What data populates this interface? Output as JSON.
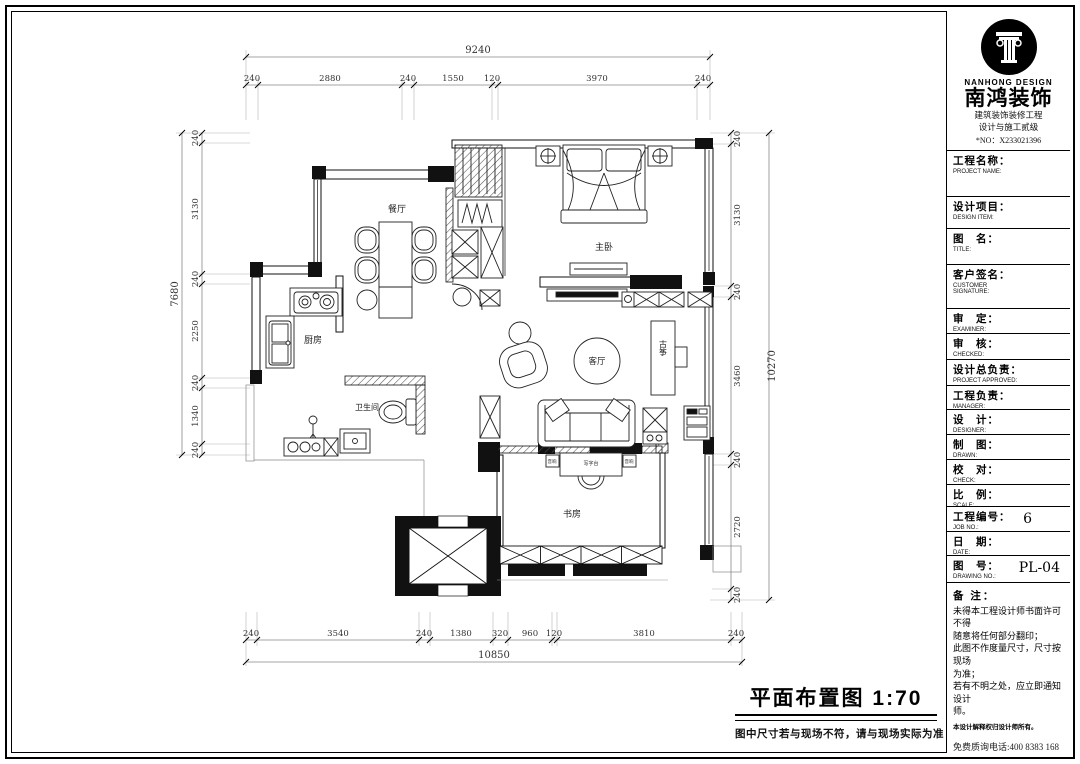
{
  "title_block": {
    "brand_en": "NANHONG DESIGN",
    "brand_zh": "南鸿装饰",
    "cert_line1": "建筑装饰装修工程",
    "cert_line2": "设计与施工贰级",
    "cert_no": "*NO：X233021396",
    "fields": [
      {
        "zh": "工程名称：",
        "en": "PROJECT NAME:",
        "value": ""
      },
      {
        "zh": "设计项目：",
        "en": "DESIGN ITEM:",
        "value": ""
      },
      {
        "zh": "图　名：",
        "en": "TITLE:",
        "value": ""
      },
      {
        "zh": "客户签名：",
        "en": "CUSTOMER SIGNATURE:",
        "value": ""
      },
      {
        "zh": "审　定：",
        "en": "EXAMINER:",
        "value": ""
      },
      {
        "zh": "审　核：",
        "en": "CHECKED:",
        "value": ""
      },
      {
        "zh": "设计总负责：",
        "en": "PROJECT APPROVED:",
        "value": ""
      },
      {
        "zh": "工程负责：",
        "en": "MANAGER:",
        "value": ""
      },
      {
        "zh": "设　计：",
        "en": "DESIGNER:",
        "value": ""
      },
      {
        "zh": "制　图：",
        "en": "DRAWN:",
        "value": ""
      },
      {
        "zh": "校　对：",
        "en": "CHECK:",
        "value": ""
      },
      {
        "zh": "比　例：",
        "en": "SCALE:",
        "value": ""
      },
      {
        "zh": "工程编号：",
        "en": "JOB NO.:",
        "value": "6"
      },
      {
        "zh": "日　期：",
        "en": "DATE:",
        "value": ""
      },
      {
        "zh": "图　号：",
        "en": "DRAWING NO.:",
        "value": "PL-04"
      }
    ],
    "notes_title": "备 注：",
    "notes": [
      "未得本工程设计师书面许可不得",
      "随意将任何部分翻印；",
      "此图不作度量尺寸，尺寸按现场",
      "为准；",
      "若有不明之处，应立即通知设计",
      "师。"
    ],
    "notes_small": "本设计解释权归设计师所有。",
    "phone": "免费质询电话:400 8383 168"
  },
  "drawing": {
    "title": "平面布置图  1:70",
    "subtitle": "图中尺寸若与现场不符，请与现场实际为准",
    "rooms": {
      "dining": "餐厅",
      "master": "主卧",
      "kitchen": "厨房",
      "bath": "卫生间",
      "living": "客厅",
      "guzheng": "古筝",
      "study": "书房"
    },
    "desk_labels": {
      "left": "音响",
      "center": "写字台",
      "right": "音响"
    }
  },
  "dims": {
    "top": {
      "total": "9240",
      "segments": [
        "240",
        "2880",
        "240",
        "1550",
        "120",
        "3970",
        "240"
      ]
    },
    "bottom": {
      "total": "10850",
      "segments": [
        "240",
        "3540",
        "240",
        "1380",
        "320",
        "960",
        "120",
        "3810",
        "240"
      ]
    },
    "left": {
      "total": "7680",
      "segments": [
        "240",
        "3130",
        "240",
        "2250",
        "240",
        "1340",
        "240"
      ]
    },
    "right": {
      "total": "10270",
      "segments": [
        "240",
        "3130",
        "240",
        "3460",
        "240",
        "2720",
        "240"
      ]
    }
  }
}
